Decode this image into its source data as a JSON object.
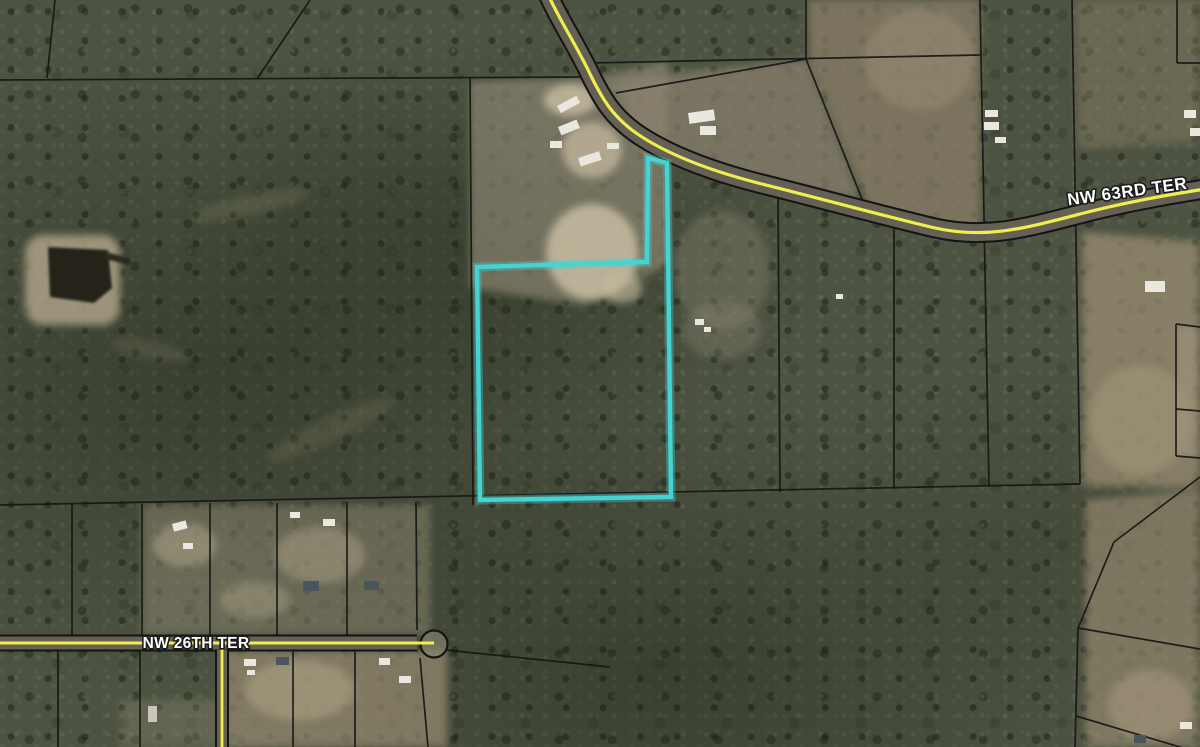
{
  "map": {
    "road_labels": [
      {
        "text": "NW 63RD TER"
      },
      {
        "text": "NW 26TH TER"
      }
    ],
    "colors": {
      "subject_parcel_outline": "#45d4d2",
      "road_centerline_yellow": "#f0ee4f",
      "parcel_boundary_black": "#161616",
      "road_label_fill": "#ffffff",
      "road_label_halo": "#1c1c1c"
    }
  }
}
